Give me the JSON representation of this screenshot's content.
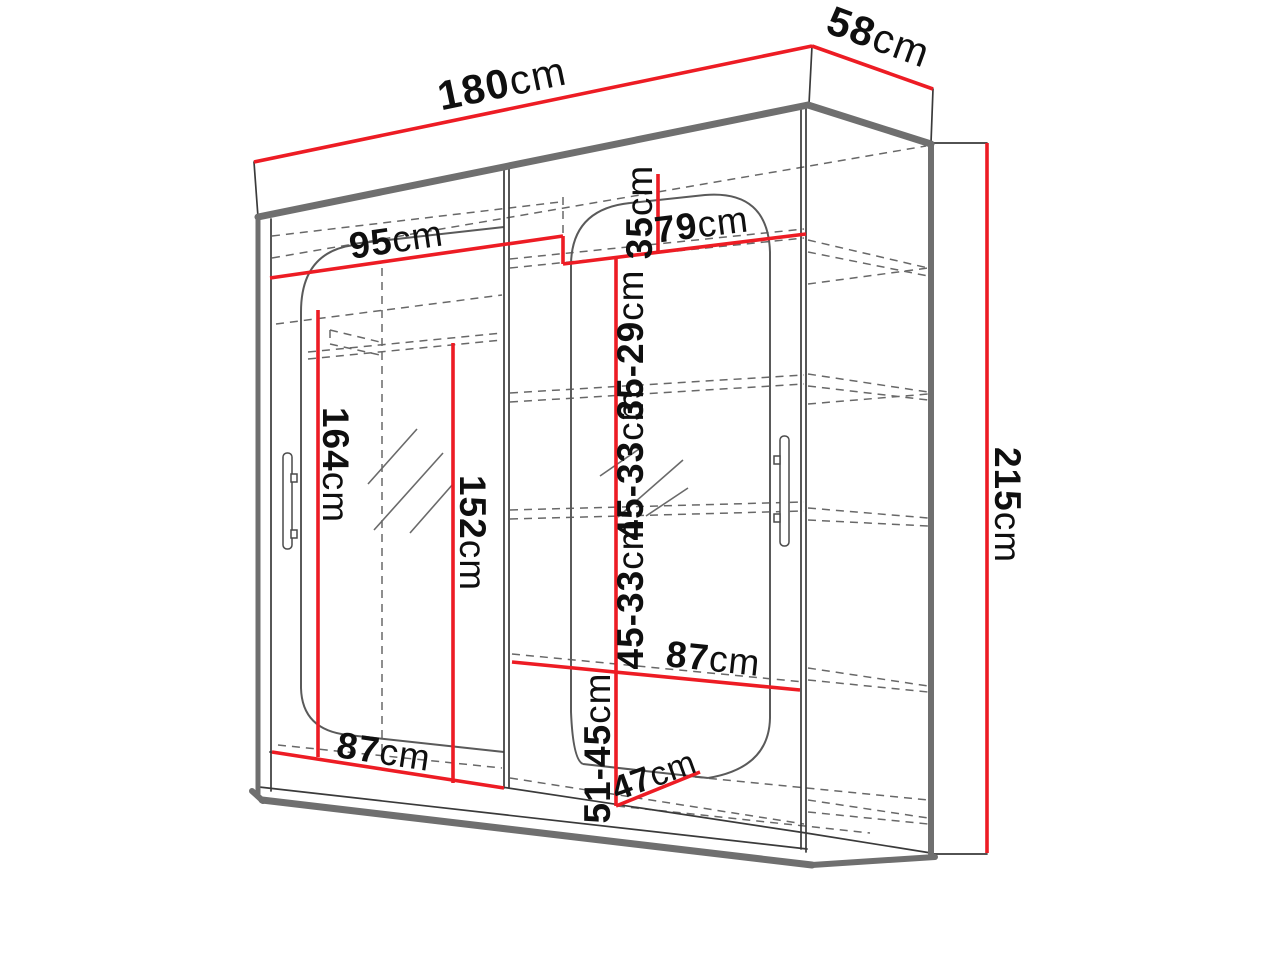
{
  "diagram": {
    "subject": "wardrobe-dimension-drawing",
    "unit": "cm",
    "colors": {
      "dimension_line": "#ed1c24",
      "outline": "#3a3a3a",
      "edge_accent": "#6f6f6f",
      "hidden_line": "#686868",
      "text": "#0f0f0f",
      "background": "#ffffff"
    },
    "dimensions": [
      {
        "id": "width-top",
        "value": "180",
        "unit": "cm"
      },
      {
        "id": "depth-top",
        "value": "58",
        "unit": "cm"
      },
      {
        "id": "shelf-width-left",
        "value": "95",
        "unit": "cm"
      },
      {
        "id": "top-compartment-height",
        "value": "35",
        "unit": "cm"
      },
      {
        "id": "shelf-width-right",
        "value": "79",
        "unit": "cm"
      },
      {
        "id": "compartment-height-2",
        "value": "35-29",
        "unit": "cm"
      },
      {
        "id": "compartment-height-3",
        "value": "45-33",
        "unit": "cm"
      },
      {
        "id": "compartment-height-4",
        "value": "45-33",
        "unit": "cm"
      },
      {
        "id": "hanging-height-left",
        "value": "164",
        "unit": "cm"
      },
      {
        "id": "hanging-height-right",
        "value": "152",
        "unit": "cm"
      },
      {
        "id": "shelf-width-middle",
        "value": "87",
        "unit": "cm"
      },
      {
        "id": "compartment-height-bottom",
        "value": "51-45",
        "unit": "cm"
      },
      {
        "id": "depth-bottom",
        "value": "47",
        "unit": "cm"
      },
      {
        "id": "width-bottom",
        "value": "87",
        "unit": "cm"
      },
      {
        "id": "total-height",
        "value": "215",
        "unit": "cm"
      }
    ]
  }
}
